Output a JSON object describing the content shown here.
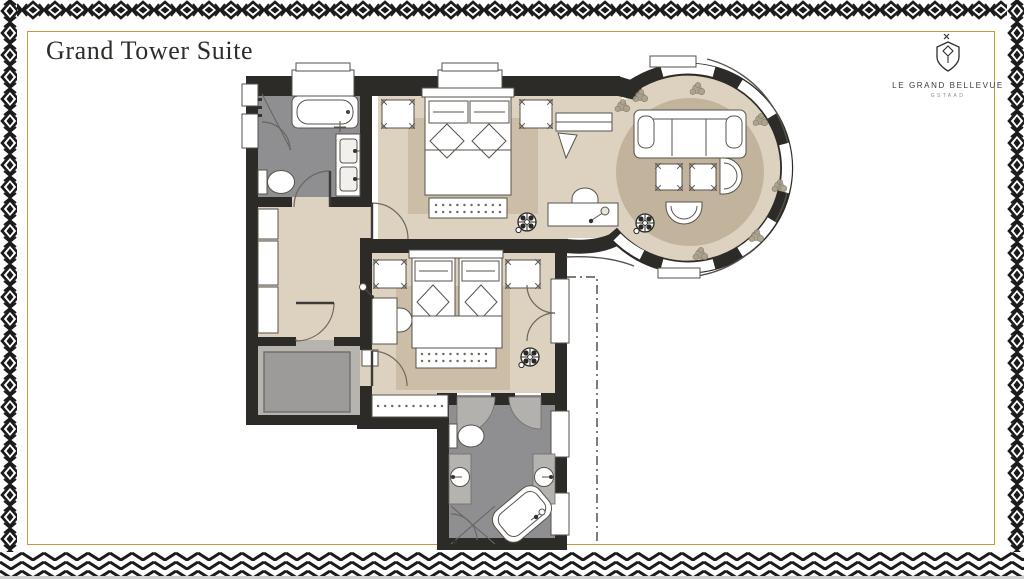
{
  "header": {
    "title": "Grand Tower Suite"
  },
  "logo": {
    "brand": "LE GRAND BELLEVUE",
    "location": "GSTAAD"
  },
  "theme": {
    "accent_gold": "#c9973b",
    "pattern_ink": "#1b1b1b",
    "wall": "#2d2b28",
    "floor_beige": "#ddd2c0",
    "rug_beige": "#cbbda6",
    "tower_rug": "#c2b39c",
    "bath_floor": "#8f8e90",
    "fixture_gray": "#b5b3af",
    "void_gray": "#9c9b99",
    "paper": "#ffffff"
  },
  "floorplan": {
    "rooms": [
      "bathroom-1",
      "hallway",
      "bedroom-1",
      "tower-lounge",
      "bedroom-2",
      "bathroom-2"
    ],
    "depicted_items": [
      "bathtub",
      "walk-in-shower",
      "double-vanity",
      "toilet",
      "wardrobes",
      "double-bed",
      "nightstands",
      "foot-bench",
      "area-rug",
      "sofa",
      "ottoman-stools",
      "tub-chairs",
      "writing-desk",
      "desk-chair",
      "desk-lamp",
      "tv",
      "cabinet",
      "round-rug",
      "twin-bed",
      "corner-bathtub",
      "washbasins",
      "ceiling-light-symbols",
      "plants",
      "dashed-boundary"
    ]
  }
}
